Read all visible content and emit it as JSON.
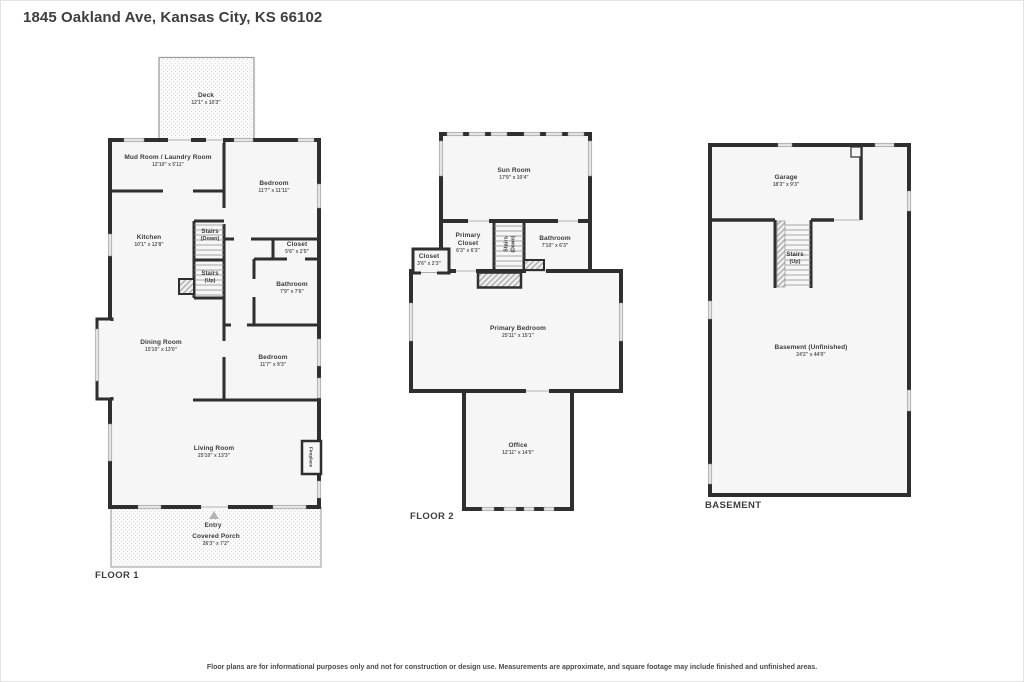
{
  "title": "1845 Oakland Ave, Kansas City, KS 66102",
  "footer": "Floor plans are for informational purposes only and not for construction or design use. Measurements are approximate, and square footage may include finished and unfinished areas.",
  "floor1": {
    "label": "FLOOR 1",
    "rooms": {
      "deck": {
        "name": "Deck",
        "dims": "12'1\" x 10'3\""
      },
      "mudroom": {
        "name": "Mud Room / Laundry Room",
        "dims": "12'10\" x 5'11\""
      },
      "bedroom_top": {
        "name": "Bedroom",
        "dims": "11'7\" x 11'11\""
      },
      "kitchen": {
        "name": "Kitchen",
        "dims": "10'1\" x 12'8\""
      },
      "stairs_down": {
        "name": "Stairs",
        "dims": "(Down)"
      },
      "stairs_up": {
        "name": "Stairs",
        "dims": "(Up)"
      },
      "closet": {
        "name": "Closet",
        "dims": "5'6\" x 2'5\""
      },
      "bathroom": {
        "name": "Bathroom",
        "dims": "7'9\" x 7'6\""
      },
      "dining": {
        "name": "Dining Room",
        "dims": "15'10\" x 13'0\""
      },
      "bedroom_mid": {
        "name": "Bedroom",
        "dims": "11'7\" x 9'3\""
      },
      "living": {
        "name": "Living Room",
        "dims": "25'10\" x 13'3\""
      },
      "fireplace": {
        "name": "Fireplace"
      },
      "entry": {
        "name": "Entry"
      },
      "porch": {
        "name": "Covered Porch",
        "dims": "26'3\" x 7'2\""
      }
    }
  },
  "floor2": {
    "label": "FLOOR 2",
    "rooms": {
      "sunroom": {
        "name": "Sun Room",
        "dims": "17'9\" x 10'4\""
      },
      "primary_closet": {
        "name": "Primary Closet",
        "dims": "6'3\" x 6'3\""
      },
      "stairs_down": {
        "name": "Stairs",
        "dims": "(Down)"
      },
      "bathroom": {
        "name": "Bathroom",
        "dims": "7'10\" x 6'3\""
      },
      "closet": {
        "name": "Closet",
        "dims": "3'6\" x 2'3\""
      },
      "primary_bedroom": {
        "name": "Primary Bedroom",
        "dims": "25'11\" x 15'1\""
      },
      "office": {
        "name": "Office",
        "dims": "12'11\" x 14'0\""
      }
    }
  },
  "basement": {
    "label": "BASEMENT",
    "rooms": {
      "garage": {
        "name": "Garage",
        "dims": "18'3\" x 9'3\""
      },
      "stairs_up": {
        "name": "Stairs",
        "dims": "(Up)"
      },
      "basement_room": {
        "name": "Basement (Unfinished)",
        "dims": "24'2\" x 44'0\""
      }
    }
  }
}
